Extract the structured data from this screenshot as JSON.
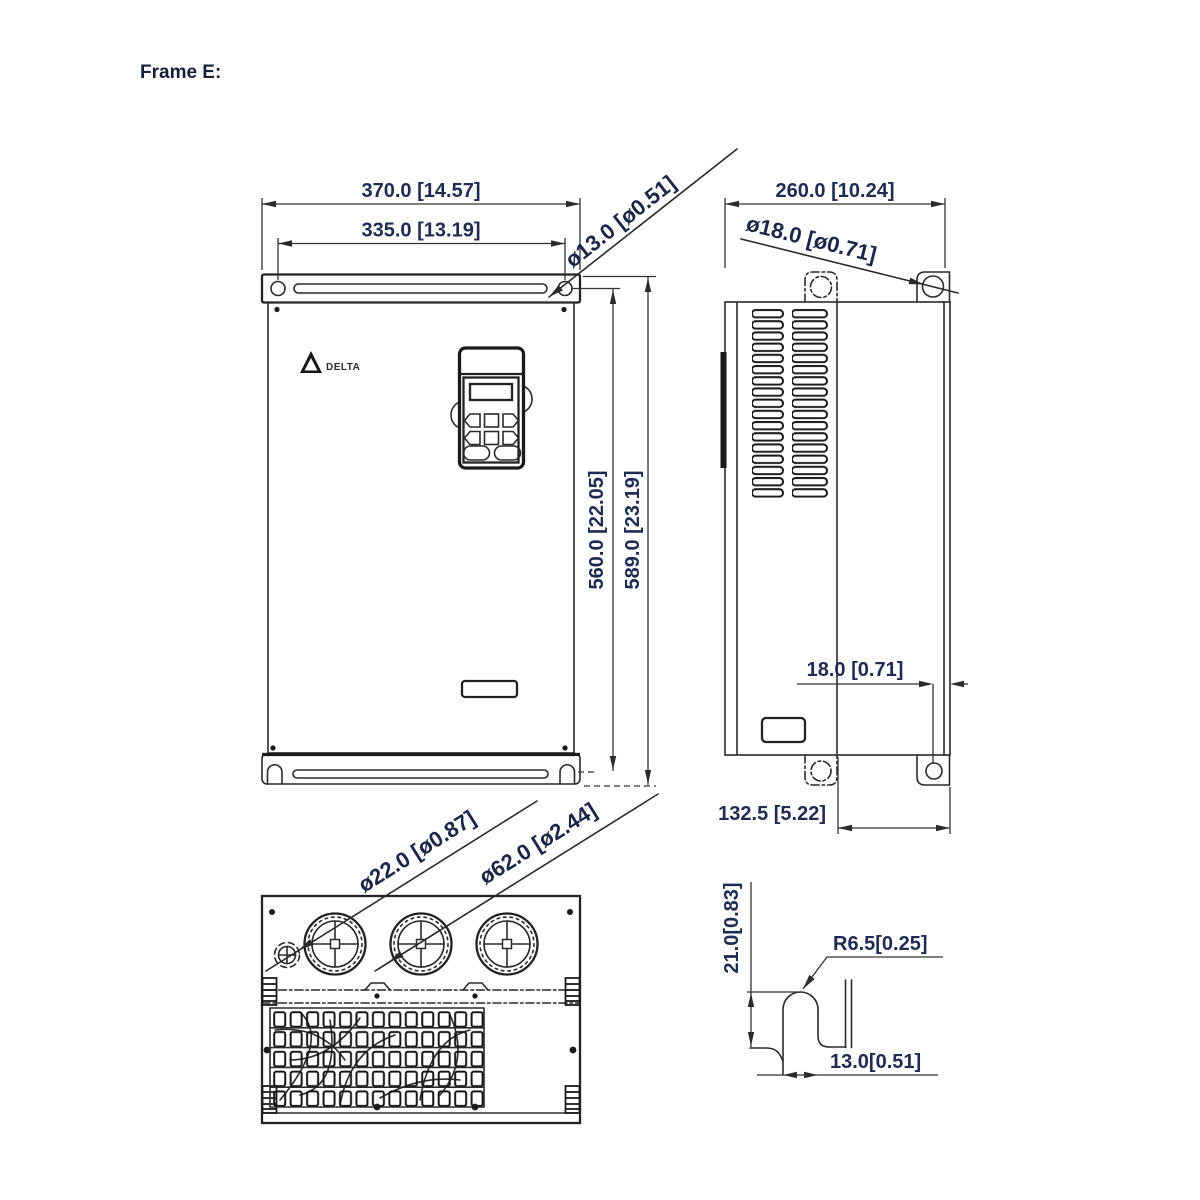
{
  "title": "Frame E:",
  "logo_text": "DELTA",
  "front_view": {
    "dim_width": "370.0 [14.57]",
    "dim_hole_span": "335.0 [13.19]",
    "dim_top_hole_dia": "ø13.0 [ø0.51]",
    "dim_hole_height": "560.0 [22.05]",
    "dim_overall_height": "589.0 [23.19]"
  },
  "side_view": {
    "dim_depth": "260.0 [10.24]",
    "dim_tab_hole_dia": "ø18.0  [ø0.71]",
    "dim_hole_edge_offset": "18.0 [0.71]",
    "dim_mount_depth": "132.5 [5.22]"
  },
  "bottom_view": {
    "dim_small_hole_dia": "ø22.0  [ø0.87]",
    "dim_fan_hole_dia": "ø62.0  [ø2.44]"
  },
  "detail_view": {
    "dim_slot_height": "21.0[0.83]",
    "dim_fillet_radius": "R6.5[0.25]",
    "dim_slot_width": "13.0[0.51]"
  }
}
